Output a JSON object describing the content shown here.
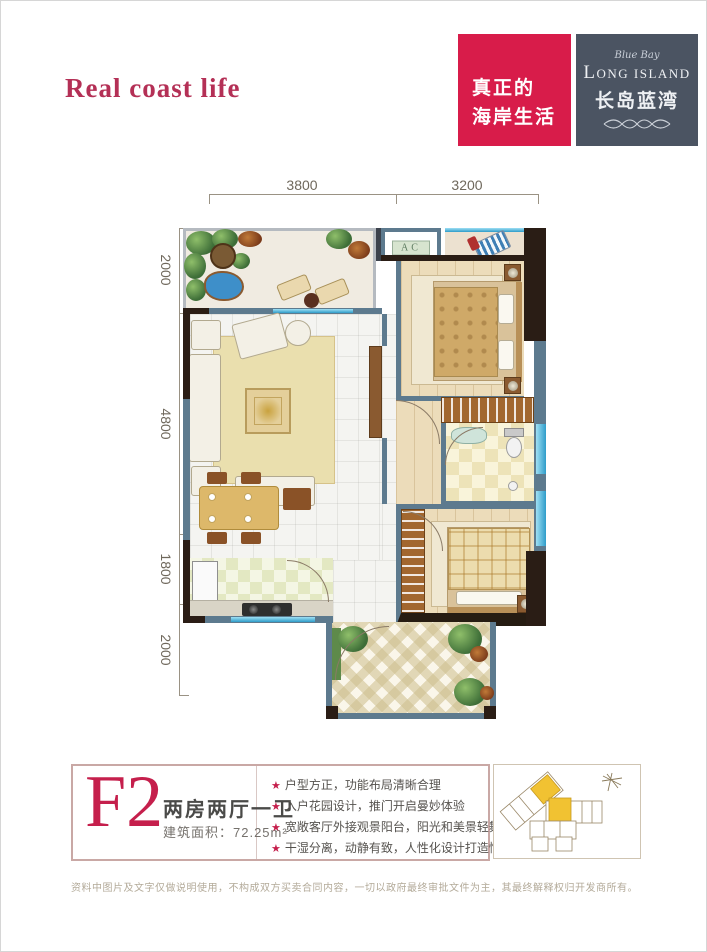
{
  "header": {
    "tagline": "Real coast life",
    "slogan_line1": "真正的",
    "slogan_line2": "海岸生活",
    "logo": {
      "script": "Blue Bay",
      "en": "LONG ISLAND",
      "cn": "长岛蓝湾"
    }
  },
  "dimensions": {
    "top": [
      "3800",
      "3200"
    ],
    "left": [
      "2000",
      "4800",
      "1800",
      "2000"
    ]
  },
  "plan": {
    "ac_label": "AC"
  },
  "unit": {
    "code": "F2",
    "type": "两房两厅一卫",
    "area_label": "建筑面积：72.25m²"
  },
  "features": [
    {
      "bullet": "★",
      "text": "户型方正，功能布局清晰合理"
    },
    {
      "bullet": "★",
      "text": "入户花园设计，推门开启曼妙体验"
    },
    {
      "bullet": "★",
      "text": "宽敞客厅外接观景阳台，阳光和美景轻舞跃动"
    },
    {
      "bullet": "★",
      "text": "干湿分离，动静有致，人性化设计打造惬意生活"
    }
  ],
  "footer": {
    "disclaimer": "资料中图片及文字仅做说明使用，不构成双方买卖合同内容，一切以政府最终审批文件为主，其最终解释权归开发商所有。"
  },
  "colors": {
    "accent": "#c51f4c",
    "slogan_bg": "#d81c4a",
    "logo_bg": "#4b5462",
    "wall_dark": "#2a1d15",
    "wall_steel": "#5d7a8e",
    "window": "#49b4e0",
    "unit_highlight": "#f1c232"
  }
}
